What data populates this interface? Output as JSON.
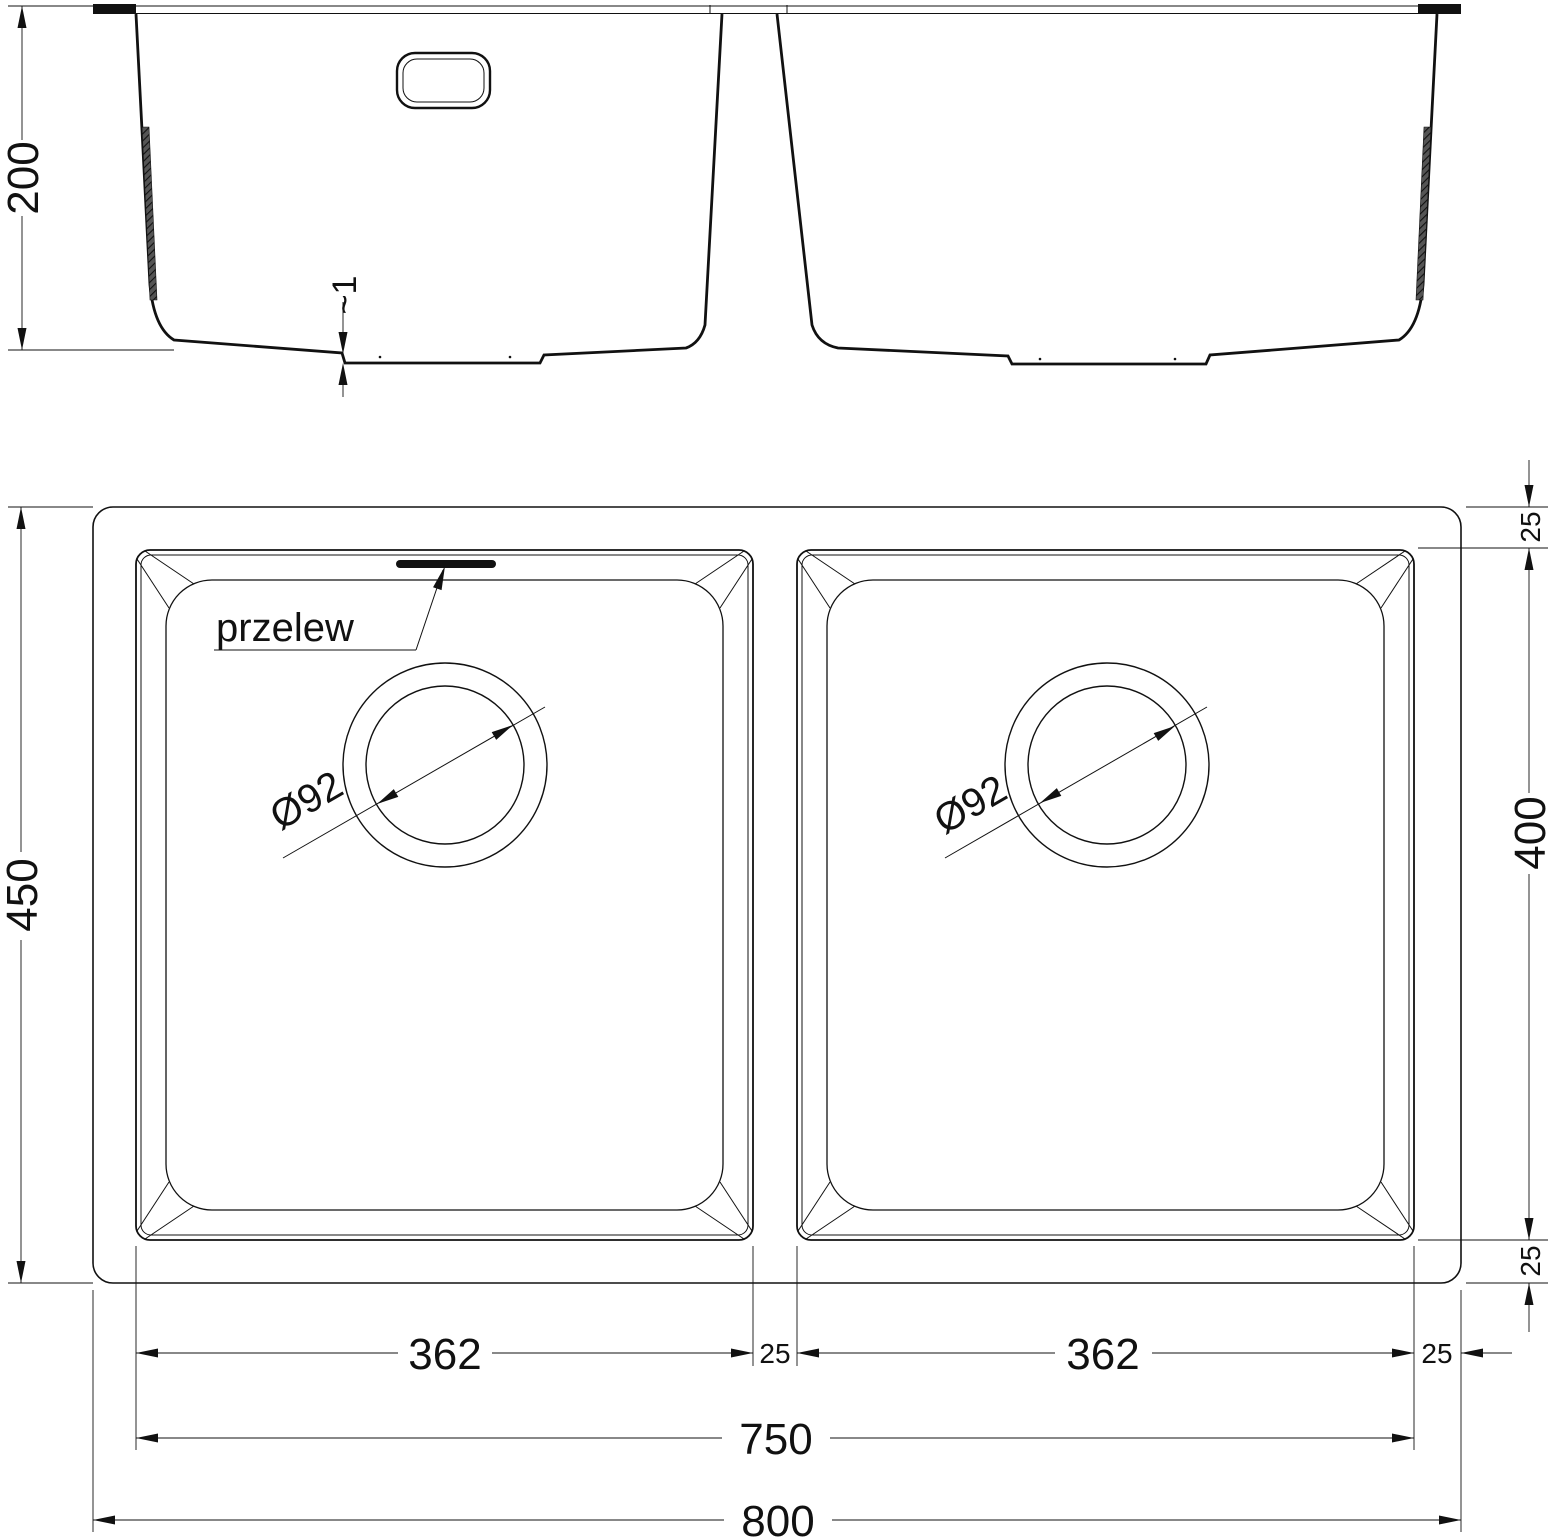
{
  "drawing": {
    "section": {
      "depth": "200",
      "floor_offset": "~1"
    },
    "plan": {
      "overflow": "przelew",
      "drain_left": "Ø92",
      "drain_right": "Ø92",
      "height_total": "450",
      "height_bowl": "400",
      "rim_top": "25",
      "rim_bottom": "25",
      "bowl_left_width": "362",
      "gap_center": "25",
      "bowl_right_width": "362",
      "rim_right": "25",
      "span_bowls": "750",
      "width_total": "800"
    },
    "colors": {
      "line": "#111111",
      "background": "#ffffff"
    }
  }
}
